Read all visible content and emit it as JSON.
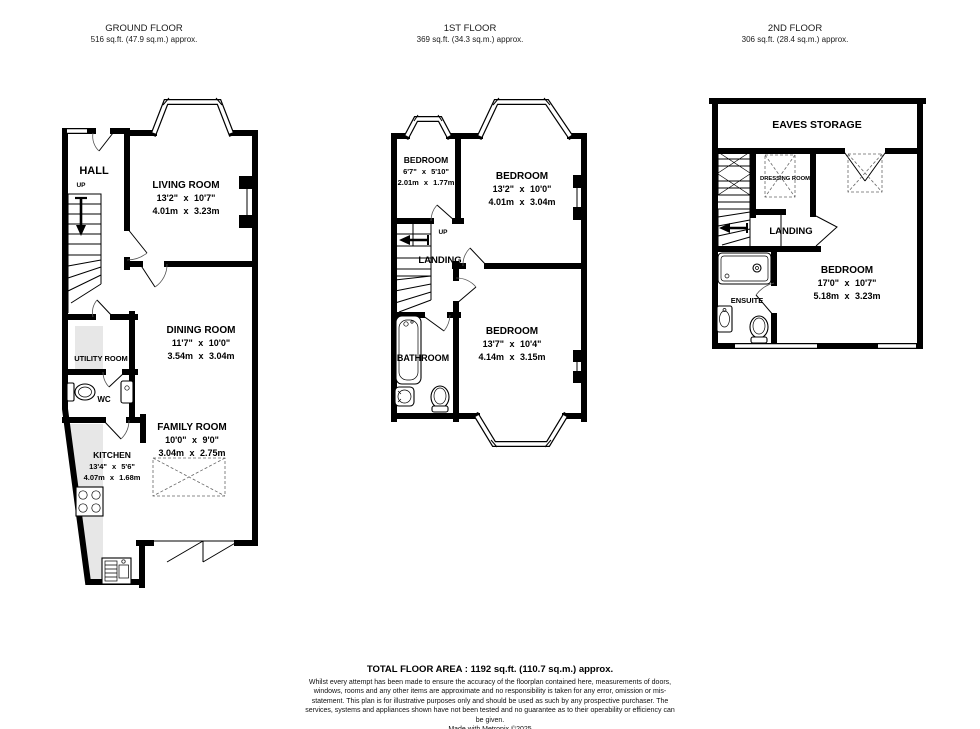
{
  "floors": [
    {
      "title": "GROUND FLOOR",
      "area": "516 sq.ft. (47.9 sq.m.) approx.",
      "labels": {
        "hall": "HALL",
        "up": "UP",
        "living": {
          "name": "LIVING ROOM",
          "ft": "13'2\" x 10'7\"",
          "m": "4.01m x 3.23m"
        },
        "dining": {
          "name": "DINING ROOM",
          "ft": "11'7\" x 10'0\"",
          "m": "3.54m x 3.04m"
        },
        "utility": "UTILITY ROOM",
        "wc": "WC",
        "family": {
          "name": "FAMILY ROOM",
          "ft": "10'0\" x 9'0\"",
          "m": "3.04m x 2.75m"
        },
        "kitchen": {
          "name": "KITCHEN",
          "ft": "13'4\" x 5'6\"",
          "m": "4.07m x 1.68m"
        }
      }
    },
    {
      "title": "1ST FLOOR",
      "area": "369 sq.ft. (34.3 sq.m.) approx.",
      "labels": {
        "bedroom_small": {
          "name": "BEDROOM",
          "ft": "6'7\" x 5'10\"",
          "m": "2.01m x 1.77m"
        },
        "bedroom_front": {
          "name": "BEDROOM",
          "ft": "13'2\" x 10'0\"",
          "m": "4.01m x 3.04m"
        },
        "up": "UP",
        "landing": "LANDING",
        "bathroom": "BATHROOM",
        "bedroom_rear": {
          "name": "BEDROOM",
          "ft": "13'7\" x 10'4\"",
          "m": "4.14m x 3.15m"
        }
      }
    },
    {
      "title": "2ND FLOOR",
      "area": "306 sq.ft. (28.4 sq.m.) approx.",
      "labels": {
        "eaves": "EAVES STORAGE",
        "dressing": "DRESSING ROOM",
        "landing": "LANDING",
        "ensuite": "ENSUITE",
        "bedroom": {
          "name": "BEDROOM",
          "ft": "17'0\" x 10'7\"",
          "m": "5.18m x 3.23m"
        }
      }
    }
  ],
  "footer": {
    "total": "TOTAL FLOOR AREA : 1192 sq.ft. (110.7 sq.m.) approx.",
    "disclaimer": "Whilst every attempt has been made to ensure the accuracy of the floorplan contained here, measurements of doors, windows, rooms and any other items are approximate and no responsibility is taken for any error, omission or mis-statement. This plan is for illustrative purposes only and should be used as such by any prospective purchaser. The services, systems and appliances shown have not been tested and no guarantee as to their operability or efficiency can be given.",
    "credit": "Made with Metropix ©2025"
  }
}
